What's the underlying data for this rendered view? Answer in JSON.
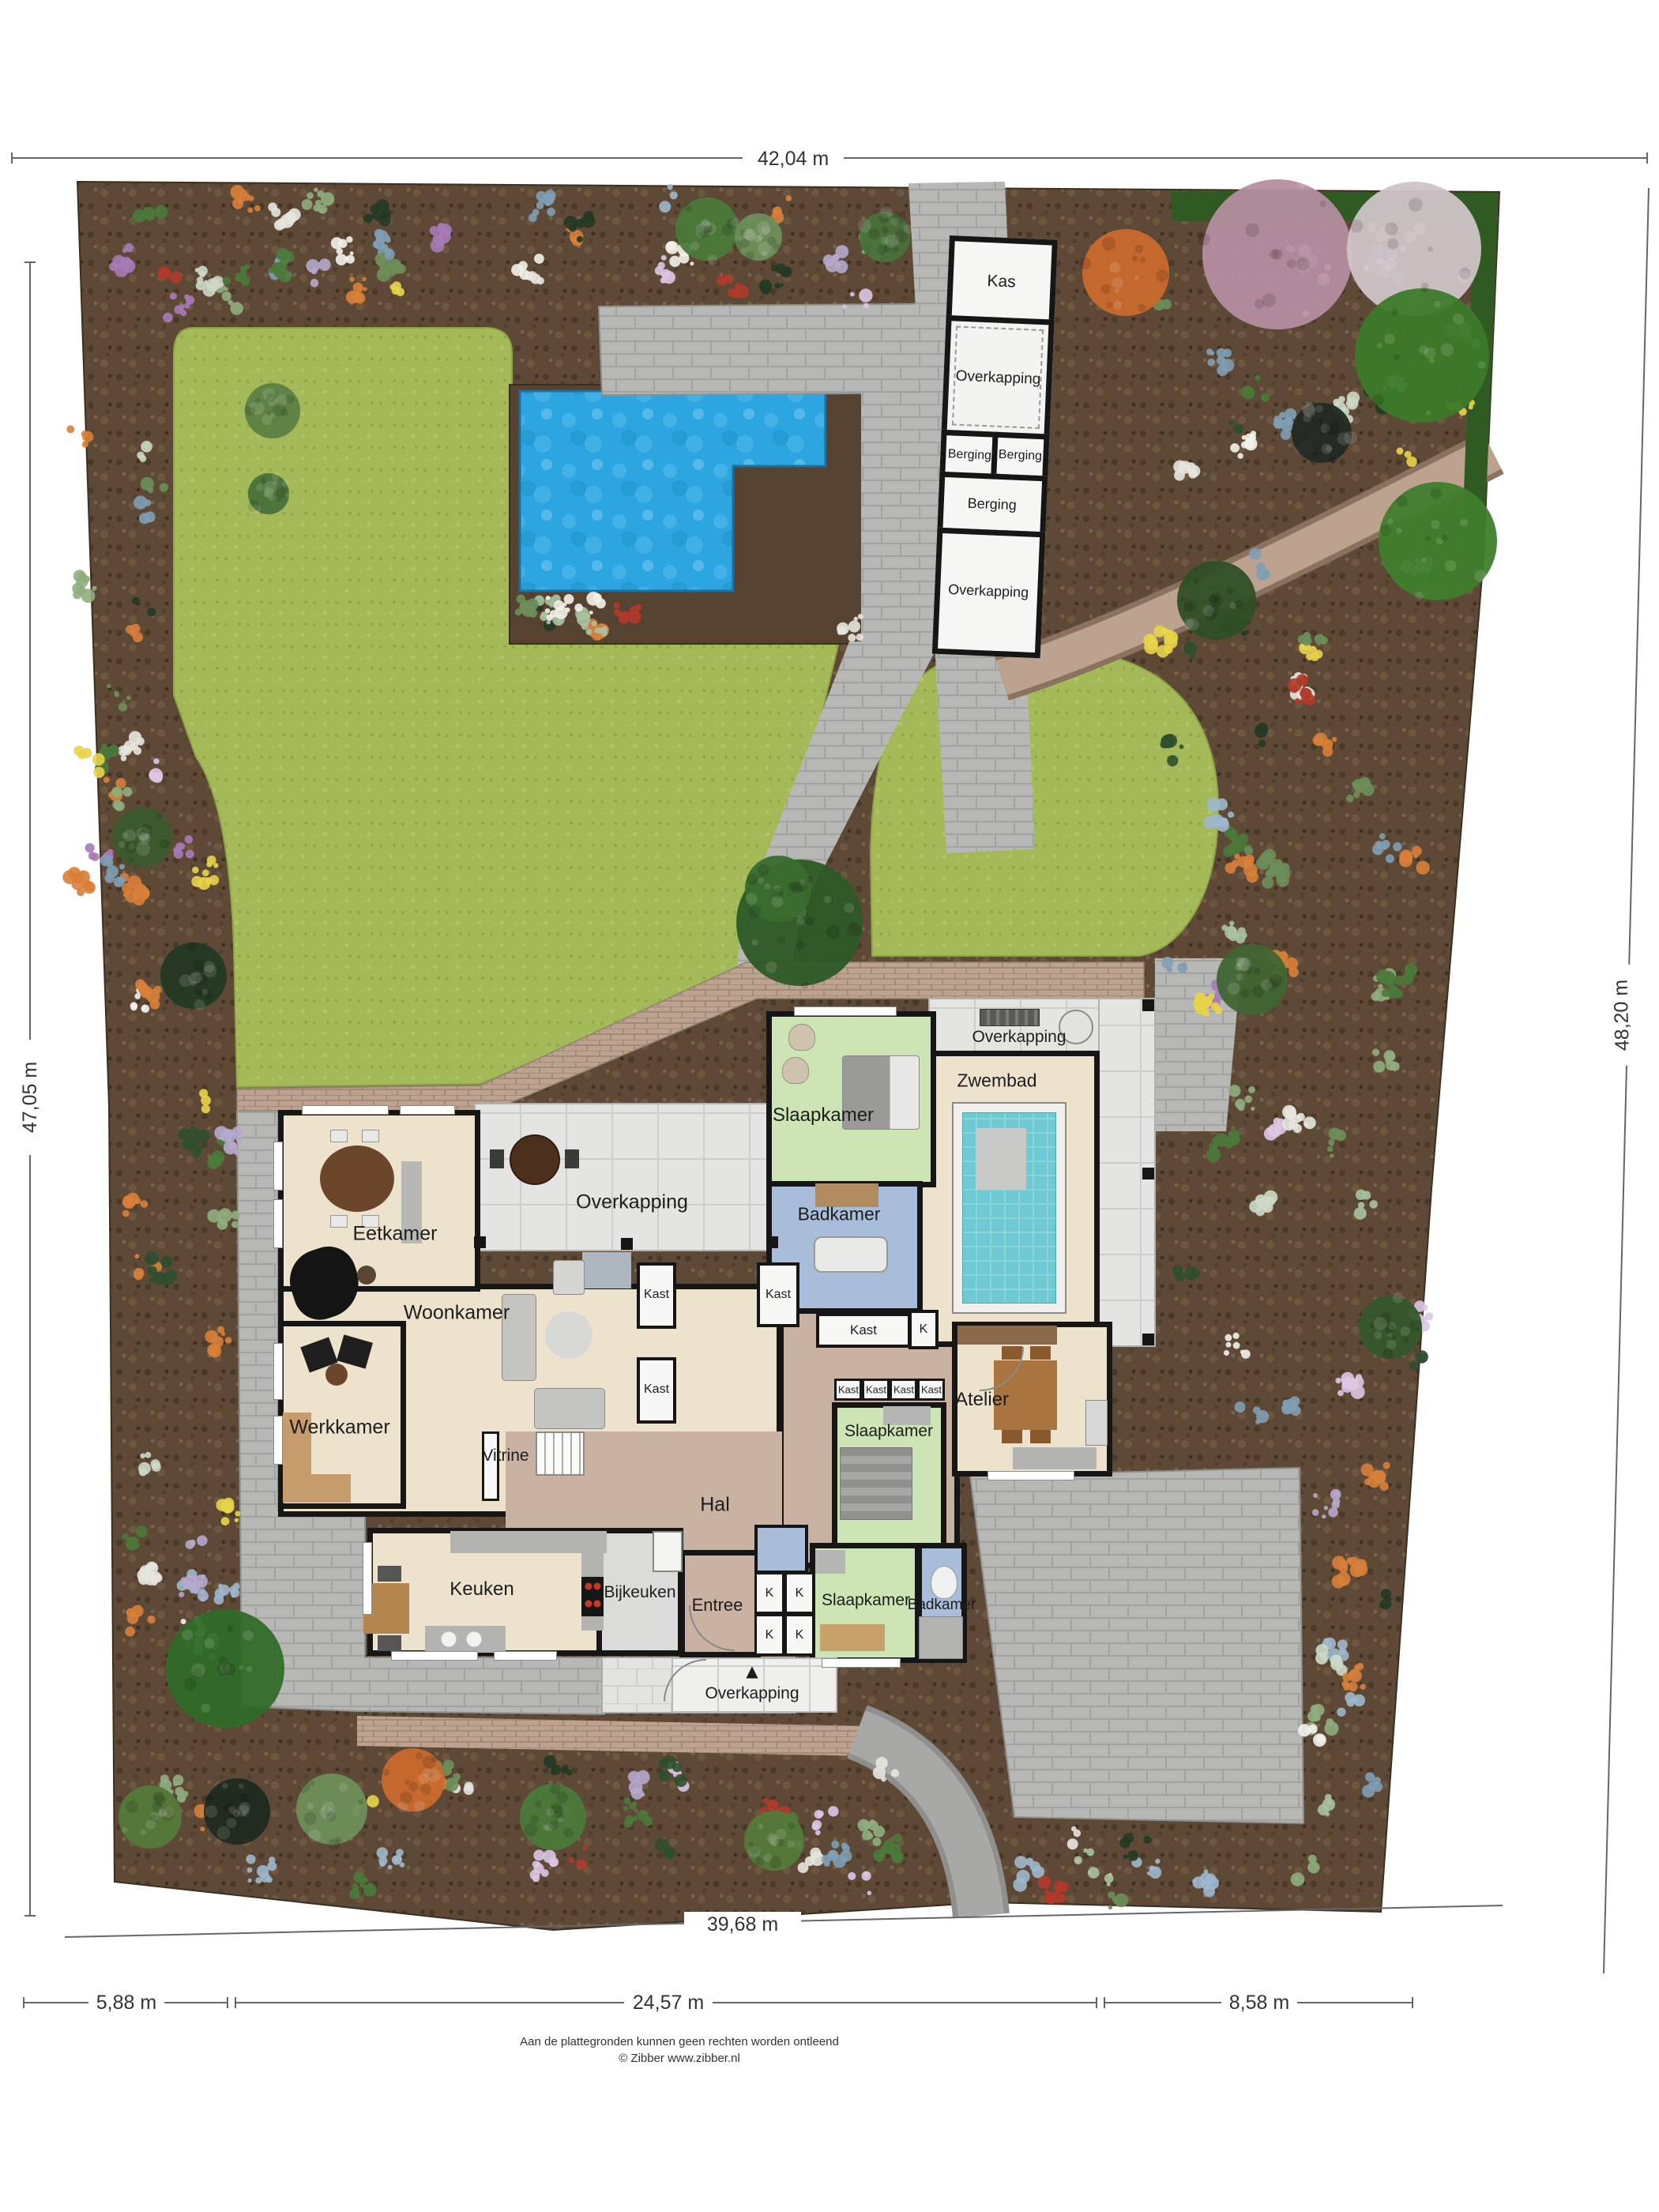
{
  "dimensions": {
    "top": "42,04 m",
    "left": "47,05 m",
    "right": "48,20 m",
    "bottom_diagonal": "39,68 m",
    "bottom_segments": [
      "5,88 m",
      "24,57 m",
      "8,58 m"
    ]
  },
  "outbuildings": {
    "kas": "Kas",
    "overkapping_top": "Overkapping",
    "berging_left": "Berging",
    "berging_right": "Berging",
    "berging_large": "Berging",
    "overkapping_bottom": "Overkapping"
  },
  "house": {
    "eetkamer": "Eetkamer",
    "overkapping_patio": "Overkapping",
    "woonkamer": "Woonkamer",
    "werkkamer": "Werkkamer",
    "vitrine": "Vitrine",
    "hal": "Hal",
    "slaapkamer_noord": "Slaapkamer",
    "badkamer_noord": "Badkamer",
    "zwembad": "Zwembad",
    "overkapping_zwembad": "Overkapping",
    "kast_wand_1": "Kast",
    "kast_wand_2": "Kast",
    "kast_hal": "Kast",
    "kast_gang": "Kast",
    "k_gang": "K",
    "kast_rij": [
      "Kast",
      "Kast",
      "Kast",
      "Kast"
    ],
    "slaapkamer_midden": "Slaapkamer",
    "atelier": "Atelier",
    "keuken": "Keuken",
    "bijkeuken": "Bijkeuken",
    "entree": "Entree",
    "k_kasten": [
      "K",
      "K",
      "K",
      "K"
    ],
    "slaapkamer_zuid": "Slaapkamer",
    "badkamer_zuid": "Badkamer",
    "overkapping_entree": "Overkapping",
    "north_arrow": "▲"
  },
  "footer": {
    "line1": "Aan de plattegronden kunnen geen rechten worden ontleend",
    "line2": "© Zibber www.zibber.nl"
  },
  "colors": {
    "soil": "#5d4936",
    "lawn": "#a4ba58",
    "water_outdoor": "#2da5e0",
    "water_indoor": "#6ec9d2",
    "paving": "#b7b7b5",
    "brick": "#bda28f",
    "room_cream": "#ede3cc",
    "room_green": "#cde4b4",
    "room_blue": "#a7bdd9",
    "hal_tan": "#c9b2a1",
    "wall": "#161616",
    "hedge": "#2f5a22"
  }
}
